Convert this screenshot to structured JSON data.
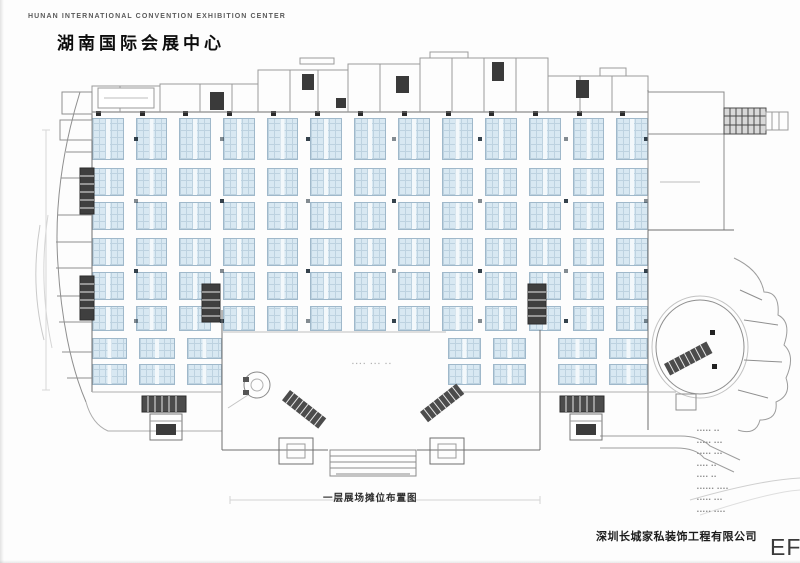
{
  "header": {
    "title_en": "HUNAN INTERNATIONAL CONVENTION EXHIBITION CENTER",
    "title_cn": "湖南国际会展中心"
  },
  "caption": {
    "text": "一层展场摊位布置图"
  },
  "footer": {
    "company": "深圳长城家私装饰工程有限公司",
    "watermark": "EF"
  },
  "lobby_note": "▪▪▪▪ ▪▪▪ ▪▪",
  "legend": {
    "lines": [
      "▪▪▪▪▪ ▪▪",
      "▪▪▪▪▪ ▪▪▪",
      "▪▪▪▪▪ ▪▪▪",
      "▪▪▪▪ ▪▪",
      "▪▪▪▪ ▪▪",
      "▪▪▪▪▪▪ ▪▪▪▪",
      "▪▪▪▪▪ ▪▪▪",
      "▪▪▪▪▪ ▪▪▪▪"
    ]
  },
  "colors": {
    "booth_fill": "#d8e8f2",
    "booth_grid": "#bdd2e0",
    "booth_border": "#9fb8ca",
    "wall": "#8a8a8a",
    "dark": "#3f3f3f"
  },
  "plan": {
    "bands": [
      {
        "x": 92,
        "y": 118,
        "w": 556,
        "cols": 13,
        "rows": 1,
        "rowH": 42,
        "rowGap": 0,
        "gapx": 12
      },
      {
        "x": 92,
        "y": 168,
        "w": 556,
        "cols": 13,
        "rows": 2,
        "rowH": 28,
        "rowGap": 6,
        "gapx": 12
      },
      {
        "x": 92,
        "y": 238,
        "w": 556,
        "cols": 13,
        "rows": 2,
        "rowH": 28,
        "rowGap": 6,
        "gapx": 12
      },
      {
        "x": 92,
        "y": 306,
        "w": 556,
        "cols": 13,
        "rows": 1,
        "rowH": 25,
        "rowGap": 0,
        "gapx": 12
      },
      {
        "x": 92,
        "y": 338,
        "w": 130,
        "cols": 3,
        "rows": 2,
        "rowH": 21,
        "rowGap": 5,
        "gapx": 12
      },
      {
        "x": 448,
        "y": 338,
        "w": 78,
        "cols": 2,
        "rows": 2,
        "rowH": 21,
        "rowGap": 5,
        "gapx": 12
      },
      {
        "x": 558,
        "y": 338,
        "w": 90,
        "cols": 2,
        "rows": 2,
        "rowH": 21,
        "rowGap": 5,
        "gapx": 12
      }
    ],
    "pillars": {
      "xs": [
        134,
        220,
        306,
        392,
        478,
        564,
        644
      ],
      "ys": [
        137,
        199,
        269,
        319
      ],
      "size": 4
    },
    "wall_ticks": {
      "y": 111,
      "x0": 96,
      "pitch": 43.7,
      "n": 13,
      "size": 5
    }
  }
}
